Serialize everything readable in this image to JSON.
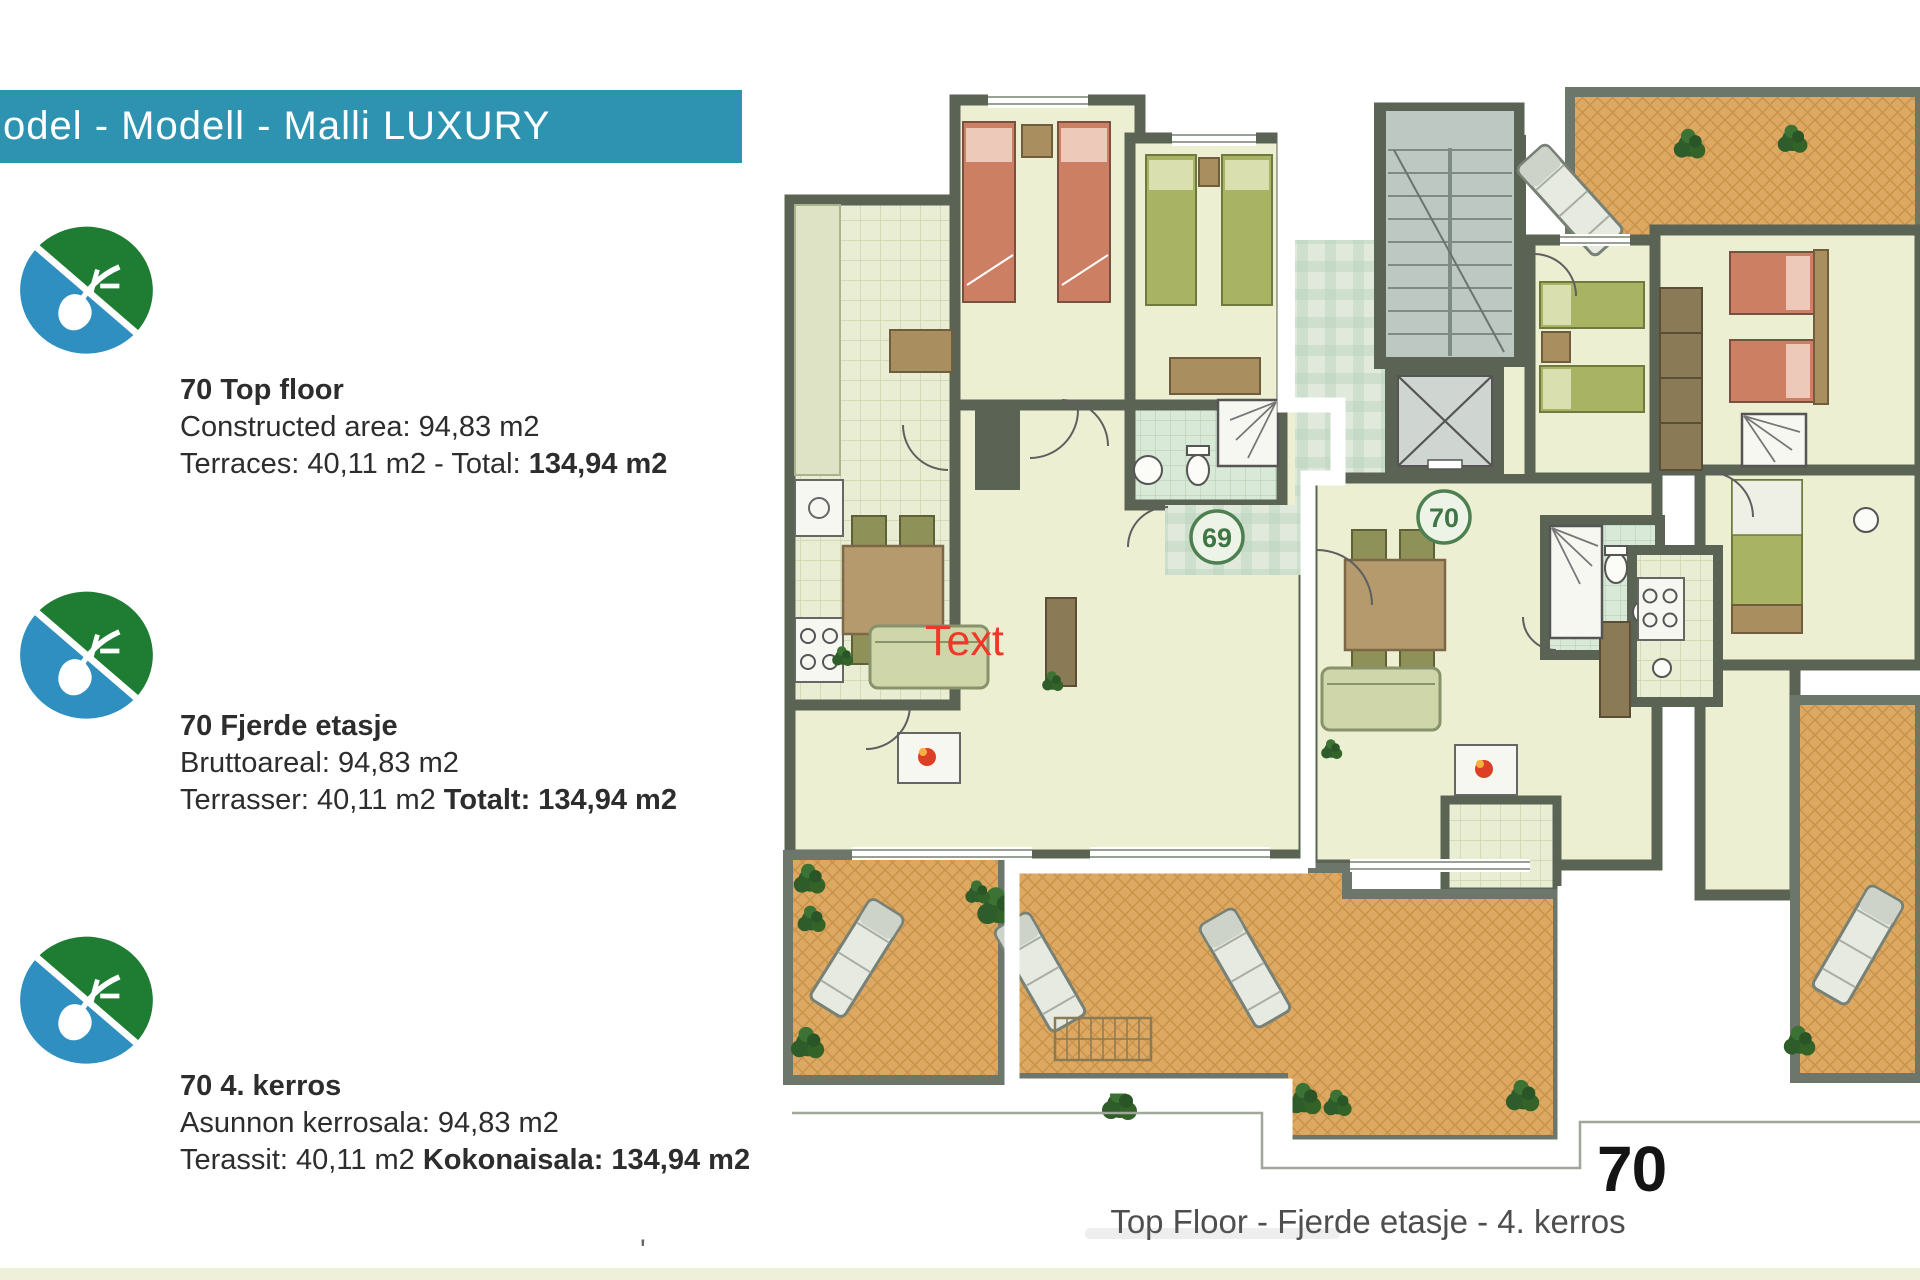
{
  "banner": {
    "label": "odel - Modell - Malli  LUXURY"
  },
  "logo": {
    "name": "leaf-water-eco-logo"
  },
  "info_blocks": [
    {
      "title": "70 Top floor",
      "line1": "Constructed area: 94,83 m2",
      "line2_normal": "Terraces: 40,11 m2 - Total: ",
      "line2_bold": "134,94 m2"
    },
    {
      "title": "70 Fjerde etasje",
      "line1": "Bruttoareal: 94,83 m2",
      "line2_normal": "Terrasser: 40,11 m2 ",
      "line2_bold": "Totalt: 134,94 m2"
    },
    {
      "title": "70 4. kerros",
      "line1": "Asunnon kerrosala: 94,83 m2",
      "line2_normal": "Terassit: 40,11 m2 ",
      "line2_bold": "Kokonaisala: 134,94 m2"
    }
  ],
  "floor_plan": {
    "badge_left": "69",
    "badge_right": "70",
    "overlay_label": "Text",
    "unit_number_large": "70",
    "caption": "Top Floor - Fjerde etasje - 4. kerros"
  },
  "colors": {
    "banner_teal": "#2e93b0",
    "wall": "#5a6354",
    "terrace": "#dca862",
    "bed_salmon": "#cd7f63",
    "bed_green": "#a9b364",
    "label_red": "#f03828",
    "logo_green": "#1e7c33",
    "logo_blue": "#2e8fc0",
    "badge_green": "#4c8050"
  }
}
